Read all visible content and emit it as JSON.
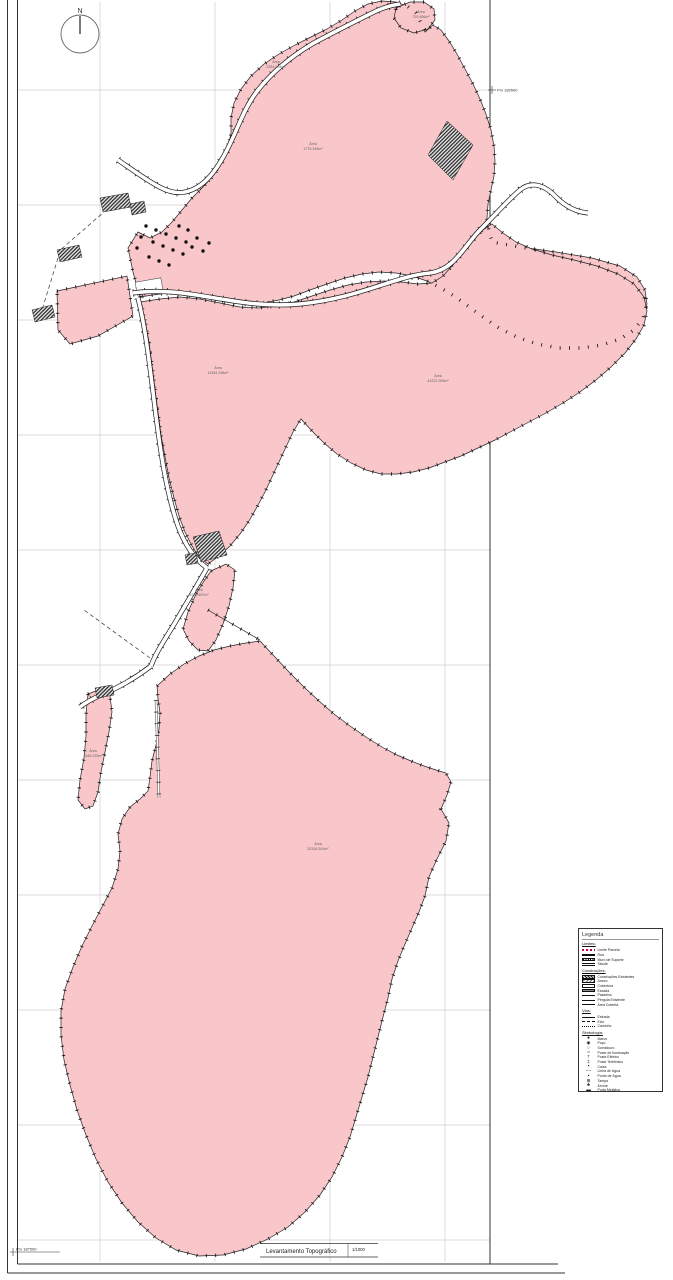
{
  "colors": {
    "parcel_pink": "#f9c6ca",
    "boundary": "#1f1f1f",
    "grid": "#cfcfcf",
    "hatch_dark": "#2a2a2a"
  },
  "north": {
    "label": "N"
  },
  "title_block": {
    "title": "Levantamento Topográfico",
    "scale": "1/1000"
  },
  "coordinates": {
    "top_right": "Pm 189500",
    "bottom_left": "Pm 187500"
  },
  "area_labels": [
    {
      "title": "Área",
      "value": "719.456m²"
    },
    {
      "title": "Área",
      "value": "2284.024m²"
    },
    {
      "title": "Área",
      "value": "1775.345m²"
    },
    {
      "title": "Área",
      "value": "11394.298m²"
    },
    {
      "title": "Área",
      "value": "41222.009m²"
    },
    {
      "title": "Área",
      "value": "3234.487m²"
    },
    {
      "title": "Área",
      "value": "1549.029m²"
    },
    {
      "title": "Área",
      "value": "52318.391m²"
    }
  ],
  "legend": {
    "title": "Legenda",
    "sections": [
      {
        "header": "Limites:",
        "items": [
          {
            "label": "Limite Parcela",
            "icon": "dash-red-line"
          },
          {
            "label": "Rua",
            "icon": "thick-black-line"
          },
          {
            "label": "Muro de Suporte",
            "icon": "hatched-bar"
          },
          {
            "label": "Talude",
            "icon": "double-line"
          }
        ]
      },
      {
        "header": "Construções:",
        "items": [
          {
            "label": "Construções Existentes",
            "icon": "dark-hatch"
          },
          {
            "label": "Anexo",
            "icon": "light-hatch"
          },
          {
            "label": "Cobertura",
            "icon": "outline-bar"
          },
          {
            "label": "Escada",
            "icon": "lined-bar"
          },
          {
            "label": "Passeios",
            "icon": "thin-line"
          },
          {
            "label": "Pérgola Existente",
            "icon": "thin-line"
          },
          {
            "label": "Área Coberta",
            "icon": "thin-line"
          }
        ]
      },
      {
        "header": "Vias:",
        "items": [
          {
            "label": "Estrada",
            "icon": "thin-line"
          },
          {
            "label": "Eixo",
            "icon": "dashed-line"
          },
          {
            "label": "Caminho",
            "icon": "dotted-line"
          }
        ]
      },
      {
        "header": "Simbologia:",
        "items": [
          {
            "label": "Marco",
            "glyph": "●",
            "icon": "marco-symbol"
          },
          {
            "label": "Poço",
            "glyph": "◉",
            "icon": "poco-symbol"
          },
          {
            "label": "Sumidouro",
            "glyph": "○",
            "icon": "sumidouro-symbol"
          },
          {
            "label": "Poste de Iluminação",
            "glyph": "☼",
            "icon": "lamp-post-symbol"
          },
          {
            "label": "Poste Elétrico",
            "glyph": "†",
            "icon": "electric-post-symbol"
          },
          {
            "label": "Poste Telefónico",
            "glyph": "‡",
            "icon": "telephone-post-symbol"
          },
          {
            "label": "Caixa",
            "glyph": "▪",
            "icon": "box-symbol"
          },
          {
            "label": "Linha de Água",
            "glyph": "╌╌",
            "icon": "water-line-symbol"
          },
          {
            "label": "Ponto de Água",
            "glyph": "•",
            "icon": "water-point-symbol"
          },
          {
            "label": "Tampa",
            "glyph": "⊞",
            "icon": "cover-symbol"
          },
          {
            "label": "Árvore",
            "glyph": "♣",
            "icon": "tree-symbol"
          },
          {
            "label": "Porta Metálica",
            "glyph": "▬",
            "icon": "metal-gate-symbol"
          }
        ]
      }
    ]
  }
}
